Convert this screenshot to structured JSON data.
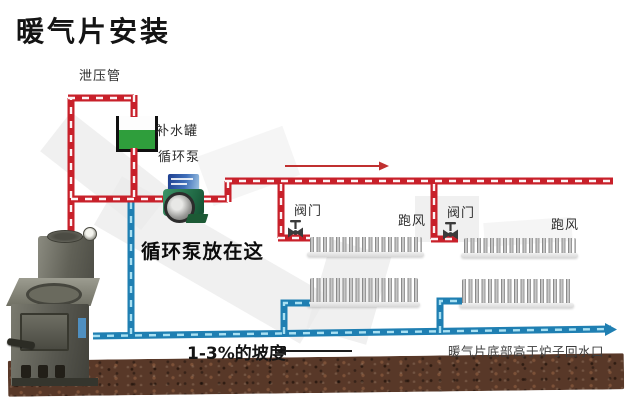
{
  "title": "暖气片安装",
  "labels": {
    "relief_pipe": "泄压管",
    "makeup_tank": "补水罐",
    "circulation_pump": "循环泵",
    "pump_note": "循环泵放在这",
    "valve": "阀门",
    "air_vent": "跑风",
    "slope_note": "1-3%的坡度",
    "height_note": "暖气片底部高于炉子回水口"
  },
  "colors": {
    "supply_pipe": "#c8202a",
    "return_pipe": "#1f7fb2",
    "tank_water": "#2f9e3c",
    "ground": "#583828"
  }
}
